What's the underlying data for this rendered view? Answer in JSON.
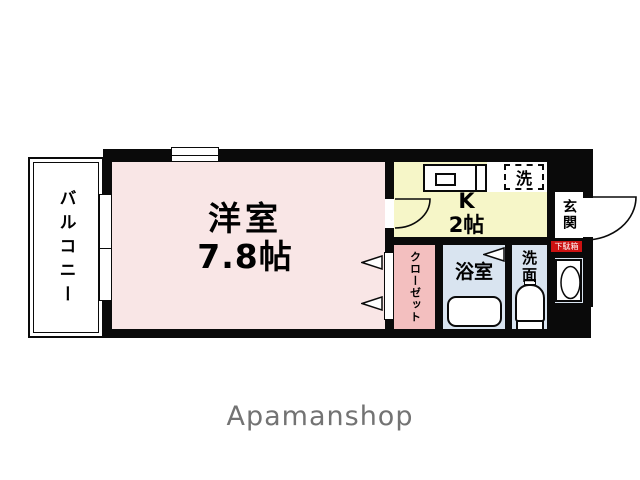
{
  "brand": {
    "text": "Apamanshop",
    "color": "#737373"
  },
  "floorplan": {
    "wall_color": "#0a0a0a",
    "balcony": {
      "label": "バルコニー"
    },
    "main_room": {
      "label": "洋室",
      "size": "7.8帖",
      "fill": "#f9e6e6"
    },
    "kitchen": {
      "label": "K",
      "size": "2帖",
      "fill": "#f6f6c8"
    },
    "laundry": {
      "label": "洗"
    },
    "entrance": {
      "label": "玄関"
    },
    "shoe_cabinet": {
      "label": "下駄箱",
      "fill": "#cc1111"
    },
    "closet": {
      "label": "クローゼット",
      "fill": "#f3bfbf"
    },
    "bathroom": {
      "label": "浴室",
      "fill": "#d9e4f0"
    },
    "washroom": {
      "label": "洗面"
    }
  }
}
